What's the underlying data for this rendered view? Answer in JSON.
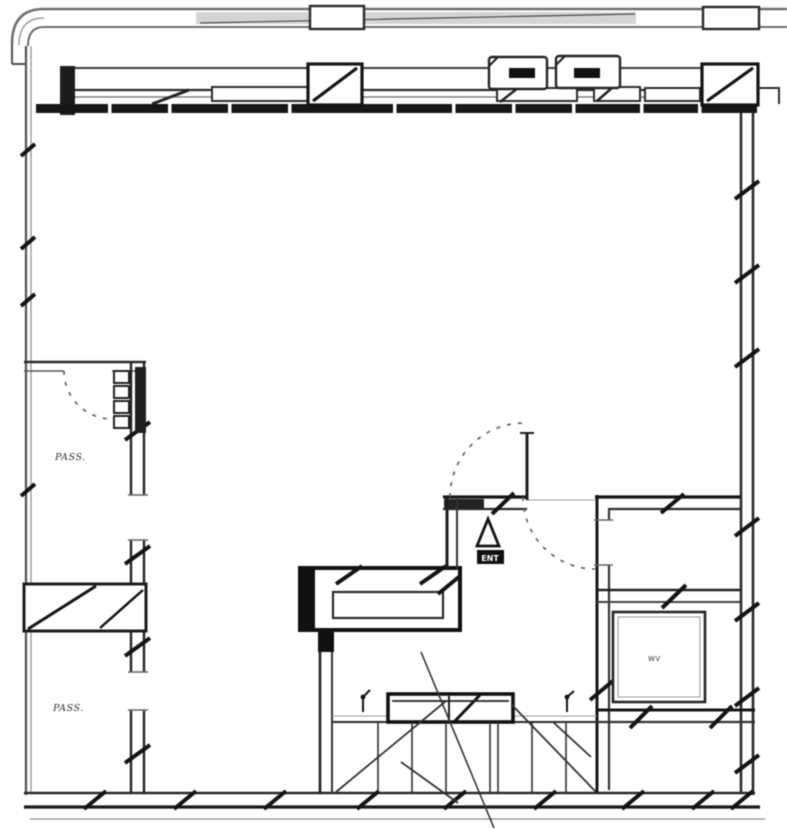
{
  "drawing": {
    "kind": "floor-plan",
    "labels": {
      "room_left_top": "PASS.",
      "room_left_bottom": "PASS.",
      "entry_tag": "ENT",
      "shaft_tag": "WV",
      "closet_tag": "F."
    },
    "colors": {
      "paper": "#ffffff",
      "ink_heavy": "#141414",
      "ink_mid": "#2a2a2a",
      "ink_light": "#8a8a8a",
      "canopy_shade": "#c2c2c2"
    }
  }
}
